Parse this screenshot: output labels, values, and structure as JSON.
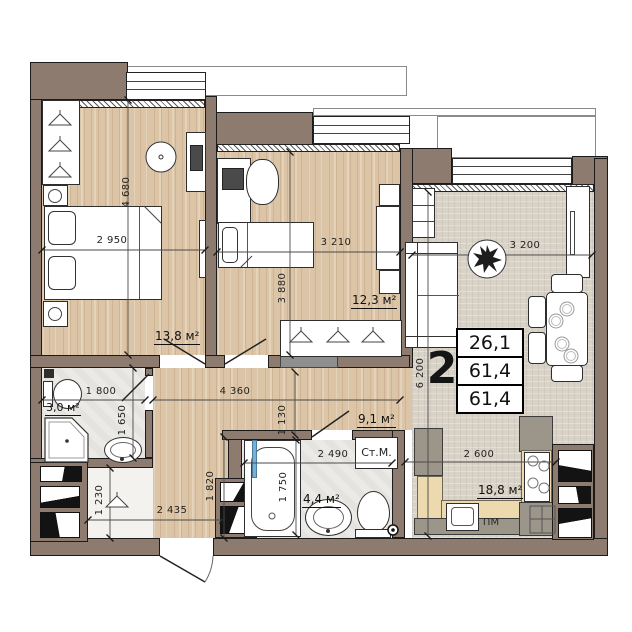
{
  "plan": {
    "rooms_count": "2",
    "info_table": {
      "living_area": "26,1",
      "total_area": "61,4",
      "reduced_area": "61,4"
    },
    "areas": {
      "bedroom1": "13,8 м²",
      "bedroom2": "12,3 м²",
      "bathroom1": "3,0 м²",
      "hallway": "9,1 м²",
      "bathroom2": "4,4 м²",
      "kitchen_living": "18,8 м²"
    },
    "dims": {
      "d4680": "4 680",
      "d2950": "2 950",
      "d3210": "3 210",
      "d3880": "3 880",
      "d3200": "3 200",
      "d6200": "6 200",
      "d1800": "1 800",
      "d1650": "1 650",
      "d4360": "4 360",
      "d1130": "1 130",
      "d1230": "1 230",
      "d2435": "2 435",
      "d1820": "1 820",
      "d2490": "2 490",
      "d1750": "1 750",
      "d2600": "2 600"
    },
    "labels": {
      "washing_machine": "Ст.М.",
      "dishwasher": "ПМ"
    },
    "colors": {
      "wall": "#8e7b70",
      "wood": "#dcc5a6",
      "carpet": "#d8d2c7",
      "tile": "#eceae6",
      "counter_tan": "#ecd9ad",
      "counter_grey": "#9b958a"
    }
  }
}
